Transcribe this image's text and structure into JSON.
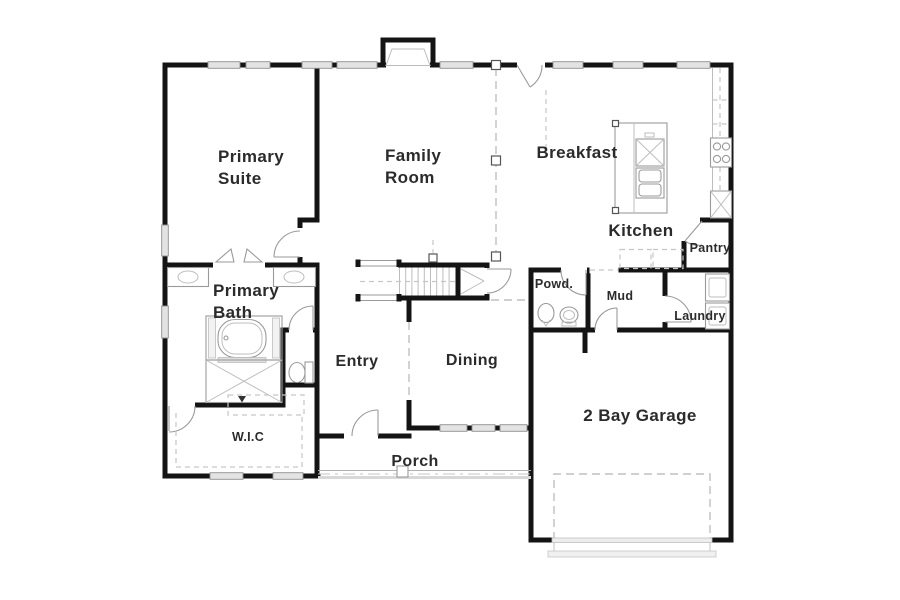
{
  "rooms": {
    "primary_suite": {
      "line1": "Primary",
      "line2": "Suite"
    },
    "family_room": {
      "line1": "Family",
      "line2": "Room"
    },
    "breakfast": {
      "label": "Breakfast"
    },
    "kitchen": {
      "label": "Kitchen"
    },
    "pantry": {
      "label": "Pantry"
    },
    "primary_bath": {
      "line1": "Primary",
      "line2": "Bath"
    },
    "powder_room": {
      "label": "Powd."
    },
    "mud_room": {
      "label": "Mud"
    },
    "laundry": {
      "label": "Laundry"
    },
    "entry": {
      "label": "Entry"
    },
    "dining": {
      "label": "Dining"
    },
    "walk_in_closet": {
      "label": "W.I.C"
    },
    "porch": {
      "label": "Porch"
    },
    "garage": {
      "label": "2 Bay Garage"
    }
  },
  "colors": {
    "wall": "#141414",
    "fixture_line": "#9a9a9a",
    "window_fill": "#e3e3e3",
    "dash_line": "#c0c0c0",
    "label_text": "#2b2b2b",
    "background": "#ffffff"
  }
}
